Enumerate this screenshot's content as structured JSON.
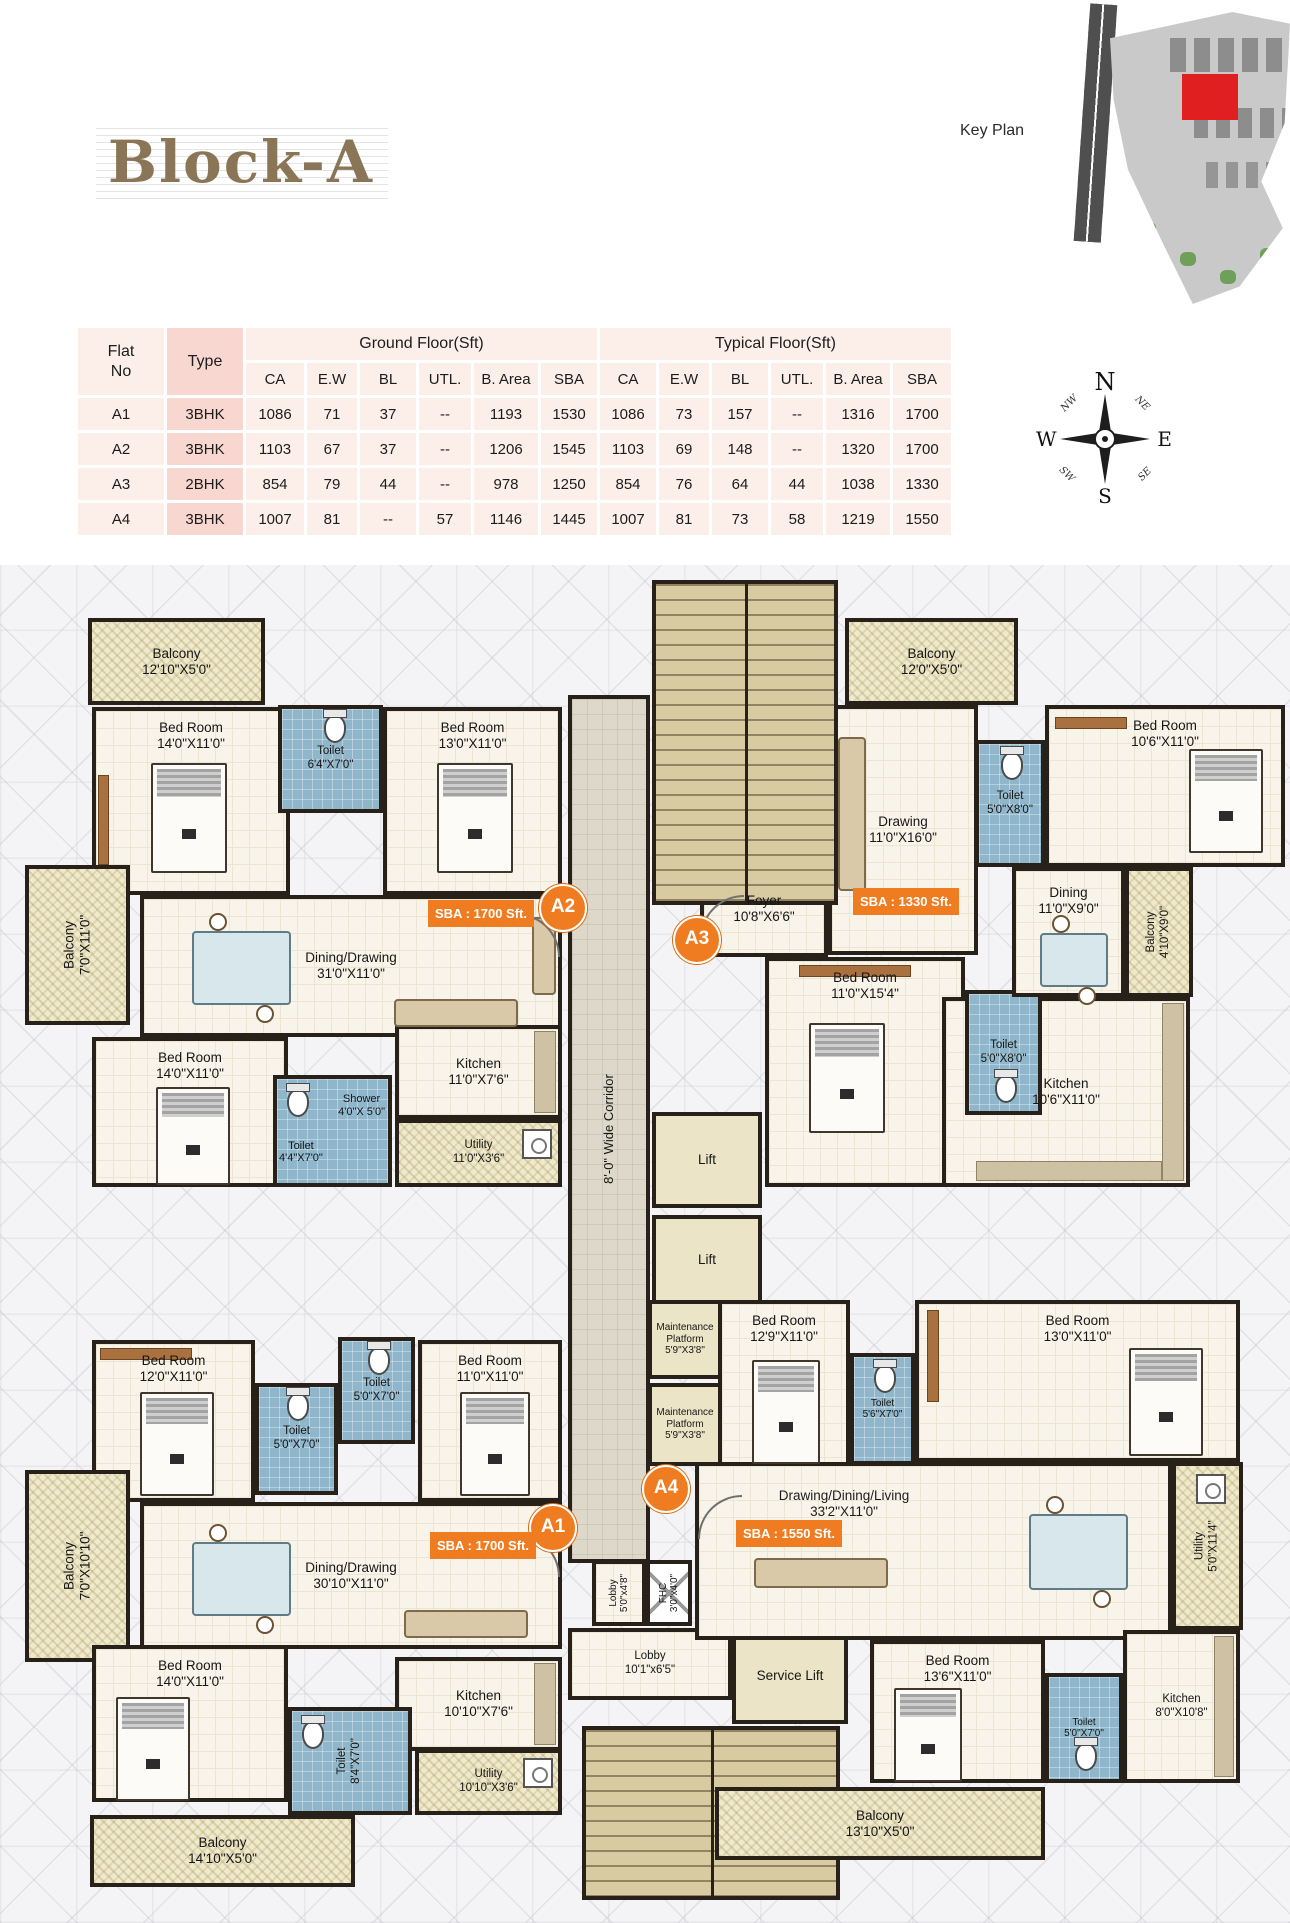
{
  "header": {
    "title": "Block-A",
    "key_plan_label": "Key Plan"
  },
  "compass": {
    "n": "N",
    "e": "E",
    "s": "S",
    "w": "W",
    "ne": "NE",
    "nw": "NW",
    "se": "SE",
    "sw": "SW"
  },
  "colors": {
    "accent_orange": "#f07c21",
    "toilet_blue": "#8fb6ca",
    "balcony_tan": "#efe9cd",
    "wall_dark": "#28211a",
    "table_pink": "#fcefe9",
    "type_col_pink": "#f7d7cf",
    "keyplan_red": "#e02020"
  },
  "table": {
    "flat_no_line1": "Flat",
    "flat_no_line2": "No",
    "type_label": "Type",
    "group1": "Ground Floor(Sft)",
    "group2": "Typical Floor(Sft)",
    "sub": [
      "CA",
      "E.W",
      "BL",
      "UTL.",
      "B. Area",
      "SBA"
    ],
    "rows": [
      {
        "flat": "A1",
        "type": "3BHK",
        "g": [
          "1086",
          "71",
          "37",
          "--",
          "1193",
          "1530"
        ],
        "t": [
          "1086",
          "73",
          "157",
          "--",
          "1316",
          "1700"
        ]
      },
      {
        "flat": "A2",
        "type": "3BHK",
        "g": [
          "1103",
          "67",
          "37",
          "--",
          "1206",
          "1545"
        ],
        "t": [
          "1103",
          "69",
          "148",
          "--",
          "1320",
          "1700"
        ]
      },
      {
        "flat": "A3",
        "type": "2BHK",
        "g": [
          "854",
          "79",
          "44",
          "--",
          "978",
          "1250"
        ],
        "t": [
          "854",
          "76",
          "64",
          "44",
          "1038",
          "1330"
        ]
      },
      {
        "flat": "A4",
        "type": "3BHK",
        "g": [
          "1007",
          "81",
          "--",
          "57",
          "1146",
          "1445"
        ],
        "t": [
          "1007",
          "81",
          "73",
          "58",
          "1219",
          "1550"
        ]
      }
    ]
  },
  "badges": {
    "a1": "A1",
    "a2": "A2",
    "a3": "A3",
    "a4": "A4",
    "sba_a1": "SBA : 1700 Sft.",
    "sba_a2": "SBA : 1700 Sft.",
    "sba_a3": "SBA : 1330 Sft.",
    "sba_a4": "SBA : 1550 Sft."
  },
  "plan": {
    "corridor": {
      "name": "8'-0\" Wide Corridor"
    },
    "rooms": {
      "a2_balc_top": {
        "name": "Balcony",
        "dims": "12'10\"X5'0\""
      },
      "a2_bed1": {
        "name": "Bed Room",
        "dims": "14'0\"X11'0\""
      },
      "a2_toilet1": {
        "name": "Toilet",
        "dims": "6'4\"X7'0\""
      },
      "a2_bed2": {
        "name": "Bed Room",
        "dims": "13'0\"X11'0\""
      },
      "a2_balc_left": {
        "name": "Balcony",
        "dims": "7'0\"X11'0\""
      },
      "a2_dining": {
        "name": "Dining/Drawing",
        "dims": "31'0\"X11'0\""
      },
      "a2_bed3": {
        "name": "Bed Room",
        "dims": "14'0\"X11'0\""
      },
      "a2_shower": {
        "name": "Shower",
        "dims": "4'0\"X 5'0\""
      },
      "a2_toilet2": {
        "name": "Toilet",
        "dims": "4'4\"X7'0\""
      },
      "a2_kitchen": {
        "name": "Kitchen",
        "dims": "11'0\"X7'6\""
      },
      "a2_utility": {
        "name": "Utility",
        "dims": "11'0\"X3'6\""
      },
      "a3_balc_top": {
        "name": "Balcony",
        "dims": "12'0\"X5'0\""
      },
      "a3_drawing": {
        "name": "Drawing",
        "dims": "11'0\"X16'0\""
      },
      "a3_toilet1": {
        "name": "Toilet",
        "dims": "5'0\"X8'0\""
      },
      "a3_bed1": {
        "name": "Bed Room",
        "dims": "10'6\"X11'0\""
      },
      "a3_foyer": {
        "name": "Foyer",
        "dims": "10'8\"X6'6\""
      },
      "a3_bed2": {
        "name": "Bed Room",
        "dims": "11'0\"X15'4\""
      },
      "a3_toilet2": {
        "name": "Toilet",
        "dims": "5'0\"X8'0\""
      },
      "a3_dining": {
        "name": "Dining",
        "dims": "11'0\"X9'0\""
      },
      "a3_balc_right": {
        "name": "Balcony",
        "dims": "4'10\"X9'0\""
      },
      "a3_kitchen": {
        "name": "Kitchen",
        "dims": "10'6\"X11'0\""
      },
      "lift1": {
        "name": "Lift"
      },
      "lift2": {
        "name": "Lift"
      },
      "maint1": {
        "name": "Maintenance Platform",
        "dims": "5'9\"X3'8\""
      },
      "maint2": {
        "name": "Maintenance Platform",
        "dims": "5'9\"X3'8\""
      },
      "lobby1": {
        "name": "Lobby",
        "dims": "5'0\"x4'8\""
      },
      "fhc": {
        "name": "FHC",
        "dims": "3'0\"x4'0\""
      },
      "lobby2": {
        "name": "Lobby",
        "dims": "10'1\"x6'5\""
      },
      "service_lift": {
        "name": "Service Lift"
      },
      "a1_bed1": {
        "name": "Bed Room",
        "dims": "12'0\"X11'0\""
      },
      "a1_toilet1": {
        "name": "Toilet",
        "dims": "5'0\"X7'0\""
      },
      "a1_toilet2": {
        "name": "Toilet",
        "dims": "5'0\"X7'0\""
      },
      "a1_bed2": {
        "name": "Bed Room",
        "dims": "11'0\"X11'0\""
      },
      "a1_balc_left": {
        "name": "Balcony",
        "dims": "7'0\"X10'10\""
      },
      "a1_dining": {
        "name": "Dining/Drawing",
        "dims": "30'10\"X11'0\""
      },
      "a1_kitchen": {
        "name": "Kitchen",
        "dims": "10'10\"X7'6\""
      },
      "a1_bed3": {
        "name": "Bed Room",
        "dims": "14'0\"X11'0\""
      },
      "a1_toilet3": {
        "name": "Toilet",
        "dims": "8'4\"X7'0\""
      },
      "a1_utility": {
        "name": "Utility",
        "dims": "10'10\"X3'6\""
      },
      "a1_balc_bottom": {
        "name": "Balcony",
        "dims": "14'10\"X5'0\""
      },
      "a4_bed1": {
        "name": "Bed Room",
        "dims": "12'9\"X11'0\""
      },
      "a4_toilet1": {
        "name": "Toilet",
        "dims": "5'6\"X7'0\""
      },
      "a4_bed2": {
        "name": "Bed Room",
        "dims": "13'0\"X11'0\""
      },
      "a4_living": {
        "name": "Drawing/Dining/Living",
        "dims": "33'2\"X11'0\""
      },
      "a4_utility": {
        "name": "Utility",
        "dims": "5'0\"X11'4\""
      },
      "a4_bed3": {
        "name": "Bed Room",
        "dims": "13'6\"X11'0\""
      },
      "a4_toilet2": {
        "name": "Toilet",
        "dims": "5'0\"X7'0\""
      },
      "a4_kitchen": {
        "name": "Kitchen",
        "dims": "8'0\"X10'8\""
      },
      "a4_balc_bottom": {
        "name": "Balcony",
        "dims": "13'10\"X5'0\""
      }
    }
  }
}
